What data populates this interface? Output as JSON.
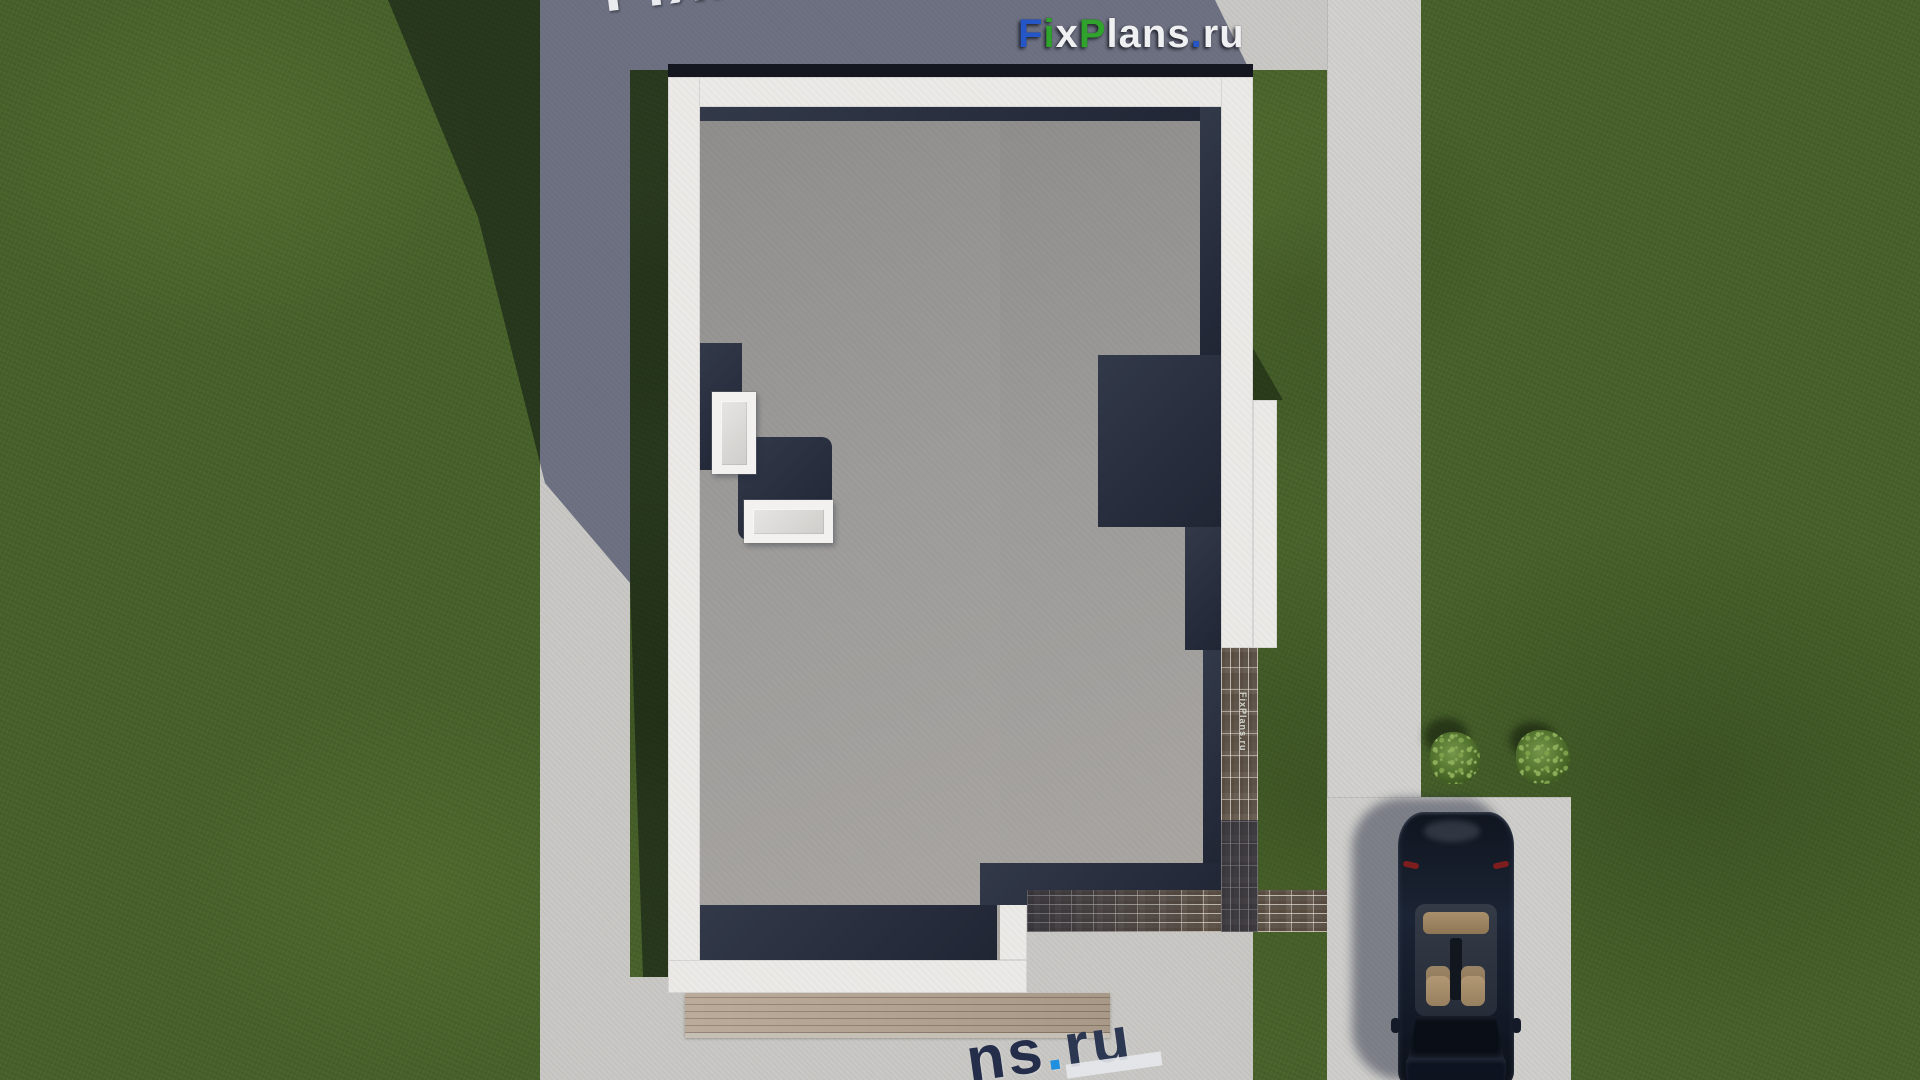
{
  "branding": {
    "logo": {
      "text": "FixPlans.ru",
      "letters": [
        {
          "ch": "F",
          "style": "color:#2456c8"
        },
        {
          "ch": "i",
          "style": "color:#2fa32c"
        },
        {
          "ch": "x",
          "style": "color:#eef0f2"
        },
        {
          "ch": "P",
          "style": "color:#2fa32c"
        },
        {
          "ch": "l",
          "style": "color:#eef0f2"
        },
        {
          "ch": "a",
          "style": "color:#eef0f2"
        },
        {
          "ch": "n",
          "style": "color:#eef0f2"
        },
        {
          "ch": "s",
          "style": "color:#eef0f2"
        },
        {
          "ch": ".",
          "style": "color:#2456c8"
        },
        {
          "ch": "r",
          "style": "color:#eef0f2"
        },
        {
          "ch": "u",
          "style": "color:#eef0f2"
        }
      ]
    },
    "watermark_top": {
      "text": "FixPlans.ru",
      "letters": [
        {
          "ch": "F",
          "style": "color:#e9ebee"
        },
        {
          "ch": "i",
          "style": "color:#e9ebee"
        },
        {
          "ch": "x",
          "style": "color:#e9ebee"
        },
        {
          "ch": "P",
          "style": "color:#36a02c"
        },
        {
          "ch": "l",
          "style": "color:#e9ebee"
        },
        {
          "ch": "a",
          "style": "color:#e9ebee"
        },
        {
          "ch": "n",
          "style": "color:#e9ebee"
        },
        {
          "ch": "s",
          "style": "color:#36a02c"
        },
        {
          "ch": ".",
          "style": "color:#2563d6"
        },
        {
          "ch": "r",
          "style": "color:#2563d6"
        },
        {
          "ch": "u",
          "style": "color:#2563d6"
        }
      ]
    },
    "watermark_bottom": {
      "text": "ns.ru",
      "letters": [
        {
          "ch": "n",
          "style": "color:#242e4a"
        },
        {
          "ch": "s",
          "style": "color:#242e4a"
        },
        {
          "ch": ".",
          "style": "color:#1f8fe0"
        },
        {
          "ch": "r",
          "style": "color:#2c3752"
        },
        {
          "ch": "u",
          "style": "color:#2c3752"
        }
      ]
    },
    "watermark_brick": {
      "text": "FixPlans.ru"
    }
  },
  "colors": {
    "grass": "#47612a",
    "grass_in_shadow": "#283c1c",
    "pavement": "#c9c8c5",
    "sidewalk": "#d2d1ce",
    "driveway": "#cfcecb",
    "roof_gray": "#9d9c9a",
    "parapet_white": "#eceae7",
    "roof_shadow_navy": "#2a3140",
    "brick_path": "#5e564e",
    "wood_deck": "#b3a290",
    "car_body": "#141b29",
    "car_seats": "#bb9f7b",
    "logo_blue": "#2456c8",
    "logo_green": "#2fa32c"
  }
}
